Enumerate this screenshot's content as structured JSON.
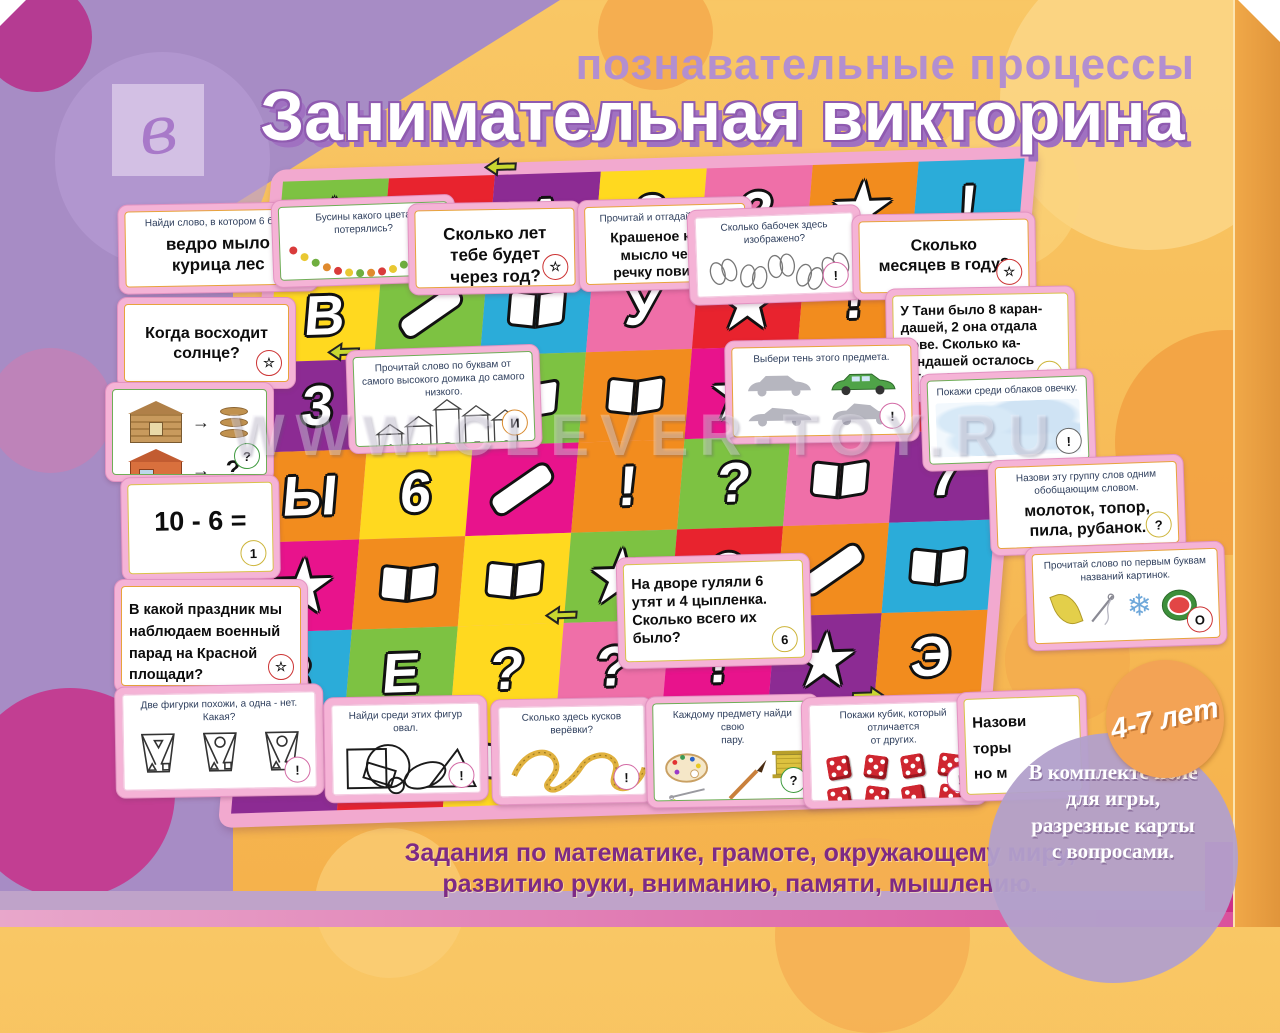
{
  "header": {
    "subtitle": "познавательные процессы",
    "title": "Занимательная викторина",
    "logo_letter": "в"
  },
  "watermark": "WWW.CLEVER-TOY.RU",
  "age_badge": "4-7 лет",
  "kit_note": "В комплекте поле\nдля игры,\nразрезные карты\nс вопросами.",
  "footer": {
    "line1": "Задания по математике, грамоте, окружающему миру,",
    "line2": "развитию руки, вниманию, памяти, мышлению."
  },
  "colors": {
    "m": "#e8138c",
    "o": "#f28c1e",
    "y": "#ffd91f",
    "g": "#7dc242",
    "r": "#e8232e",
    "p": "#8c2b93",
    "b": "#2bacd9",
    "k": "#ef6fa8"
  },
  "cards": [
    {
      "id": "find-word",
      "title": "Найди слово, в котором 6 букв.",
      "body": "ведро  мыло\nкурица  лес",
      "icon": "▤"
    },
    {
      "id": "beads",
      "title": "Бусины какого цвета потерялись?",
      "icon": "?"
    },
    {
      "id": "age-next-year",
      "body": "Сколько лет\nтебе будет\nчерез год?",
      "icon": "☆"
    },
    {
      "id": "riddle",
      "title": "Прочитай и отгадай загадку.",
      "body": "Крашеное  коро-\nмысло  через\nречку повисло.",
      "icon": "☆"
    },
    {
      "id": "butterflies",
      "title": "Сколько бабочек здесь\nизображено?",
      "icon": "!"
    },
    {
      "id": "months",
      "body": "Сколько\nмесяцев в году?",
      "icon": "☆"
    },
    {
      "id": "sunrise",
      "body": "Когда восходит\nсолнце?",
      "icon": "☆"
    },
    {
      "id": "pencils",
      "body": "У Тани было 8 каран-\nдашей, 2 она отдала\nВове.  Сколько  ка-\nрандашей  осталось\nу Тани?",
      "icon": "5"
    },
    {
      "id": "houses",
      "title": "Прочитай  слово  по  буквам  от\nсамого высокого домика до самого\nнизкого.",
      "letters": [
        "А",
        "Н",
        "В",
        "Е",
        "С"
      ],
      "icon": "И"
    },
    {
      "id": "car-shadow",
      "title": "Выбери тень этого предмета.",
      "icon": "!"
    },
    {
      "id": "clouds",
      "title": "Покажи среди облаков овечку.",
      "icon": "!"
    },
    {
      "id": "house-analogy",
      "arrow": "→",
      "question": "?",
      "icon": "?"
    },
    {
      "id": "group-word",
      "title": "Назови эту группу слов одним\nобобщающим словом.",
      "body": "молоток, топор,\nпила,  рубанок.",
      "icon": "?"
    },
    {
      "id": "subtraction",
      "body": "10 - 6 =",
      "icon": "1"
    },
    {
      "id": "first-letters",
      "title": "Прочитай слово по первым буквам\nназваний картинок.",
      "icon": "О"
    },
    {
      "id": "ducklings",
      "body": "На  дворе  гуляли  6\nутят и 4 цыпленка.\nСколько  всего  их\nбыло?",
      "icon": "6"
    },
    {
      "id": "parade",
      "body": "В какой праздник мы\nнаблюдаем  военный\nпарад на Красной\nплощади?",
      "icon": "☆"
    },
    {
      "id": "figures",
      "title": "Две фигурки похожи, а одна - нет.\nКакая?",
      "icon": "!"
    },
    {
      "id": "oval",
      "title": "Найди среди этих фигур овал.",
      "icon": "!"
    },
    {
      "id": "ropes",
      "title": "Сколько здесь кусков верёвки?",
      "icon": "!"
    },
    {
      "id": "pairs",
      "title": "Каждому  предмету  найди  свою\nпару.",
      "icon": "?"
    },
    {
      "id": "dice",
      "title": "Покажи кубик, который отличается\nот других.",
      "icon": "!"
    },
    {
      "id": "covered-card",
      "body": "Назови\nторы\nно м"
    }
  ],
  "board": {
    "rows": [
      [
        {
          "g": "star",
          "c": "g"
        },
        {
          "g": "1",
          "c": "r"
        },
        {
          "g": "А",
          "c": "p"
        },
        {
          "g": "8",
          "c": "y"
        },
        {
          "g": "?",
          "c": "k"
        },
        {
          "g": "star",
          "c": "o"
        },
        {
          "g": "!",
          "c": "b"
        }
      ],
      [
        {
          "g": "В",
          "c": "y"
        },
        {
          "g": "crayon",
          "c": "g"
        },
        {
          "g": "book",
          "c": "b"
        },
        {
          "g": "У",
          "c": "k"
        },
        {
          "g": "star",
          "c": "r"
        },
        {
          "g": "!",
          "c": "o"
        },
        {
          "g": "book",
          "c": "p"
        }
      ],
      [
        {
          "g": "3",
          "c": "p"
        },
        {
          "g": "4",
          "c": "y"
        },
        {
          "g": "book",
          "c": "g"
        },
        {
          "g": "book",
          "c": "o"
        },
        {
          "g": "star",
          "c": "m"
        },
        {
          "g": "5",
          "c": "b"
        },
        {
          "g": "star",
          "c": "r"
        }
      ],
      [
        {
          "g": "Ы",
          "c": "o"
        },
        {
          "g": "6",
          "c": "y"
        },
        {
          "g": "crayon",
          "c": "m"
        },
        {
          "g": "!",
          "c": "o"
        },
        {
          "g": "?",
          "c": "g"
        },
        {
          "g": "book",
          "c": "k"
        },
        {
          "g": "7",
          "c": "p"
        }
      ],
      [
        {
          "g": "star",
          "c": "m"
        },
        {
          "g": "book",
          "c": "o"
        },
        {
          "g": "book",
          "c": "y"
        },
        {
          "g": "star",
          "c": "g"
        },
        {
          "g": "?",
          "c": "r"
        },
        {
          "g": "crayon",
          "c": "o"
        },
        {
          "g": "book",
          "c": "b"
        }
      ],
      [
        {
          "g": "8",
          "c": "b"
        },
        {
          "g": "Е",
          "c": "g"
        },
        {
          "g": "?",
          "c": "y"
        },
        {
          "g": "?",
          "c": "k"
        },
        {
          "g": "!",
          "c": "m"
        },
        {
          "g": "star",
          "c": "p"
        },
        {
          "g": "Э",
          "c": "o"
        }
      ],
      [
        {
          "g": "star",
          "c": "p"
        },
        {
          "g": "9",
          "c": "r"
        },
        {
          "g": "book",
          "c": "y"
        },
        {
          "g": "10",
          "c": "o"
        },
        {
          "g": "star",
          "c": "k"
        },
        {
          "g": "!",
          "c": "g"
        },
        {
          "g": "book",
          "c": "b"
        }
      ]
    ]
  }
}
